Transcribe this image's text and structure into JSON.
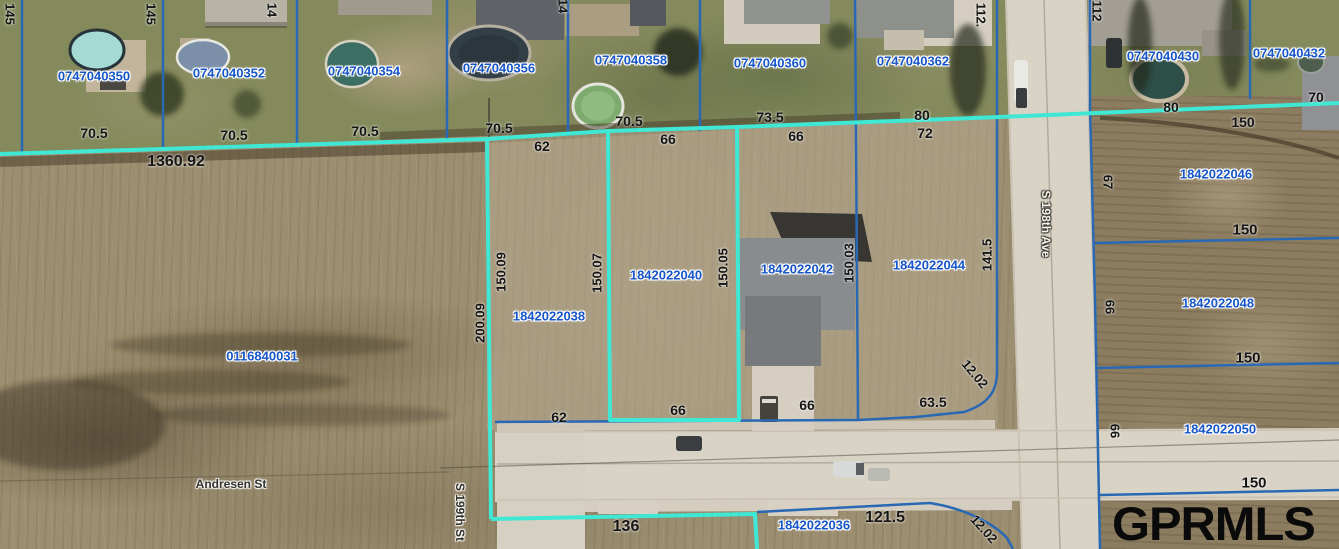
{
  "watermark": "GPRMLS",
  "colors": {
    "parcel_text": "#1656c8",
    "dimension_text": "#151515",
    "boundary_teal": "#3fe8d4",
    "boundary_blue": "#2968b4",
    "street_text_dark": "#33332d",
    "street_text_light": "#f4f3ec",
    "watermark": "#0a0a0a"
  },
  "streets": [
    {
      "name": "Andresen St",
      "x": 231,
      "y": 484,
      "rot": 0,
      "style": "dark"
    },
    {
      "name": "S 199th St",
      "x": 460,
      "y": 512,
      "rot": 90,
      "style": "dark"
    },
    {
      "name": "S 198th Ave",
      "x": 1046,
      "y": 224,
      "rot": 90,
      "style": "light"
    }
  ],
  "parcels": [
    {
      "id": "0747040350",
      "x": 94,
      "y": 76
    },
    {
      "id": "0747040352",
      "x": 229,
      "y": 73
    },
    {
      "id": "0747040354",
      "x": 364,
      "y": 71
    },
    {
      "id": "0747040356",
      "x": 499,
      "y": 68
    },
    {
      "id": "0747040358",
      "x": 631,
      "y": 60
    },
    {
      "id": "0747040360",
      "x": 770,
      "y": 63
    },
    {
      "id": "0747040362",
      "x": 913,
      "y": 61
    },
    {
      "id": "0747040430",
      "x": 1163,
      "y": 56
    },
    {
      "id": "0747040432",
      "x": 1289,
      "y": 53
    },
    {
      "id": "1842022038",
      "x": 549,
      "y": 316
    },
    {
      "id": "1842022040",
      "x": 666,
      "y": 275
    },
    {
      "id": "1842022042",
      "x": 797,
      "y": 269
    },
    {
      "id": "1842022044",
      "x": 929,
      "y": 265
    },
    {
      "id": "1842022046",
      "x": 1216,
      "y": 174
    },
    {
      "id": "1842022048",
      "x": 1218,
      "y": 303
    },
    {
      "id": "1842022050",
      "x": 1220,
      "y": 429
    },
    {
      "id": "1842022036",
      "x": 814,
      "y": 525
    },
    {
      "id": "0116840031",
      "x": 262,
      "y": 356
    }
  ],
  "dimensions": [
    {
      "text": "70.5",
      "x": 94,
      "y": 133
    },
    {
      "text": "70.5",
      "x": 234,
      "y": 135
    },
    {
      "text": "70.5",
      "x": 365,
      "y": 131
    },
    {
      "text": "70.5",
      "x": 499,
      "y": 128
    },
    {
      "text": "70.5",
      "x": 629,
      "y": 121
    },
    {
      "text": "73.5",
      "x": 770,
      "y": 117
    },
    {
      "text": "80",
      "x": 922,
      "y": 115
    },
    {
      "text": "72",
      "x": 925,
      "y": 133
    },
    {
      "text": "80",
      "x": 1171,
      "y": 107
    },
    {
      "text": "70",
      "x": 1316,
      "y": 97
    },
    {
      "text": "150",
      "x": 1243,
      "y": 122
    },
    {
      "text": "1360.92",
      "x": 176,
      "y": 162,
      "size": 16
    },
    {
      "text": "62",
      "x": 542,
      "y": 146
    },
    {
      "text": "66",
      "x": 668,
      "y": 139
    },
    {
      "text": "66",
      "x": 796,
      "y": 136
    },
    {
      "text": "62",
      "x": 559,
      "y": 417
    },
    {
      "text": "66",
      "x": 678,
      "y": 410
    },
    {
      "text": "66",
      "x": 807,
      "y": 405
    },
    {
      "text": "63.5",
      "x": 933,
      "y": 402
    },
    {
      "text": "136",
      "x": 626,
      "y": 527,
      "size": 16
    },
    {
      "text": "121.5",
      "x": 885,
      "y": 518,
      "size": 16
    },
    {
      "text": "150",
      "x": 1245,
      "y": 230,
      "size": 15
    },
    {
      "text": "150",
      "x": 1248,
      "y": 358,
      "size": 15
    },
    {
      "text": "150",
      "x": 1254,
      "y": 483,
      "size": 15
    },
    {
      "text": "145",
      "x": 10,
      "y": 14,
      "rot": 90
    },
    {
      "text": "145",
      "x": 151,
      "y": 14,
      "rot": 90
    },
    {
      "text": "14",
      "x": 272,
      "y": 10,
      "rot": 90
    },
    {
      "text": "14",
      "x": 563,
      "y": 6,
      "rot": 90
    },
    {
      "text": "112.",
      "x": 981,
      "y": 15,
      "rot": 90
    },
    {
      "text": "112",
      "x": 1097,
      "y": 11,
      "rot": 90
    },
    {
      "text": "200.09",
      "x": 480,
      "y": 323,
      "rot": -90
    },
    {
      "text": "150.09",
      "x": 501,
      "y": 272,
      "rot": -90
    },
    {
      "text": "150.07",
      "x": 597,
      "y": 273,
      "rot": -90
    },
    {
      "text": "150.05",
      "x": 723,
      "y": 268,
      "rot": -90
    },
    {
      "text": "150.03",
      "x": 849,
      "y": 263,
      "rot": -90
    },
    {
      "text": "141.5",
      "x": 987,
      "y": 255,
      "rot": -90
    },
    {
      "text": "67",
      "x": 1108,
      "y": 182,
      "rot": 90
    },
    {
      "text": "66",
      "x": 1110,
      "y": 307,
      "rot": 90
    },
    {
      "text": "66",
      "x": 1115,
      "y": 431,
      "rot": 90
    },
    {
      "text": "12.02",
      "x": 975,
      "y": 374,
      "rot": 50
    },
    {
      "text": "12.02",
      "x": 984,
      "y": 529,
      "rot": 48
    }
  ]
}
